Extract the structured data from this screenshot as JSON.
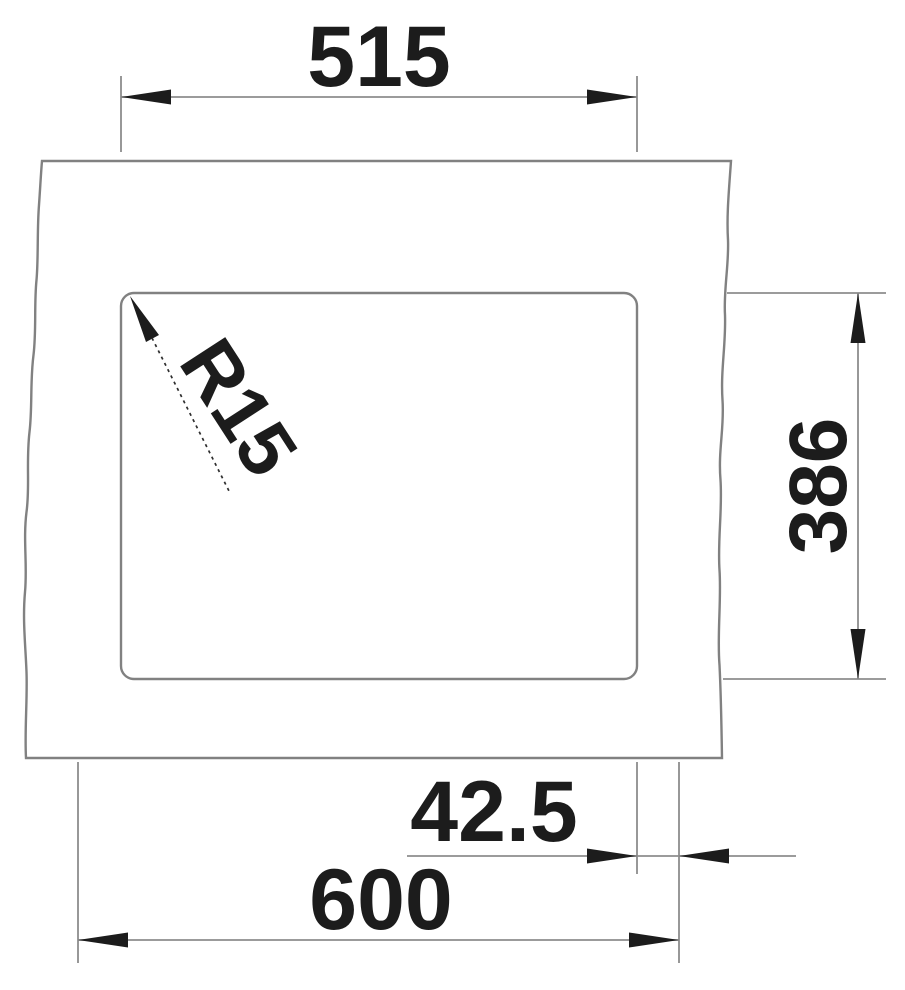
{
  "page": {
    "background_color": "#ffffff"
  },
  "drawing": {
    "subject": "undermount-sink-cutout-dimension-drawing",
    "labels": {
      "width_top": "515",
      "height_right": "386",
      "offset_bottom": "42.5",
      "width_bottom": "600",
      "corner_radius": "R15"
    },
    "colors": {
      "outline": "#818181",
      "dimension_line": "#8d8d8d",
      "arrow": "#1c1c1c",
      "text": "#1c1c1c",
      "background": "#ffffff"
    }
  }
}
